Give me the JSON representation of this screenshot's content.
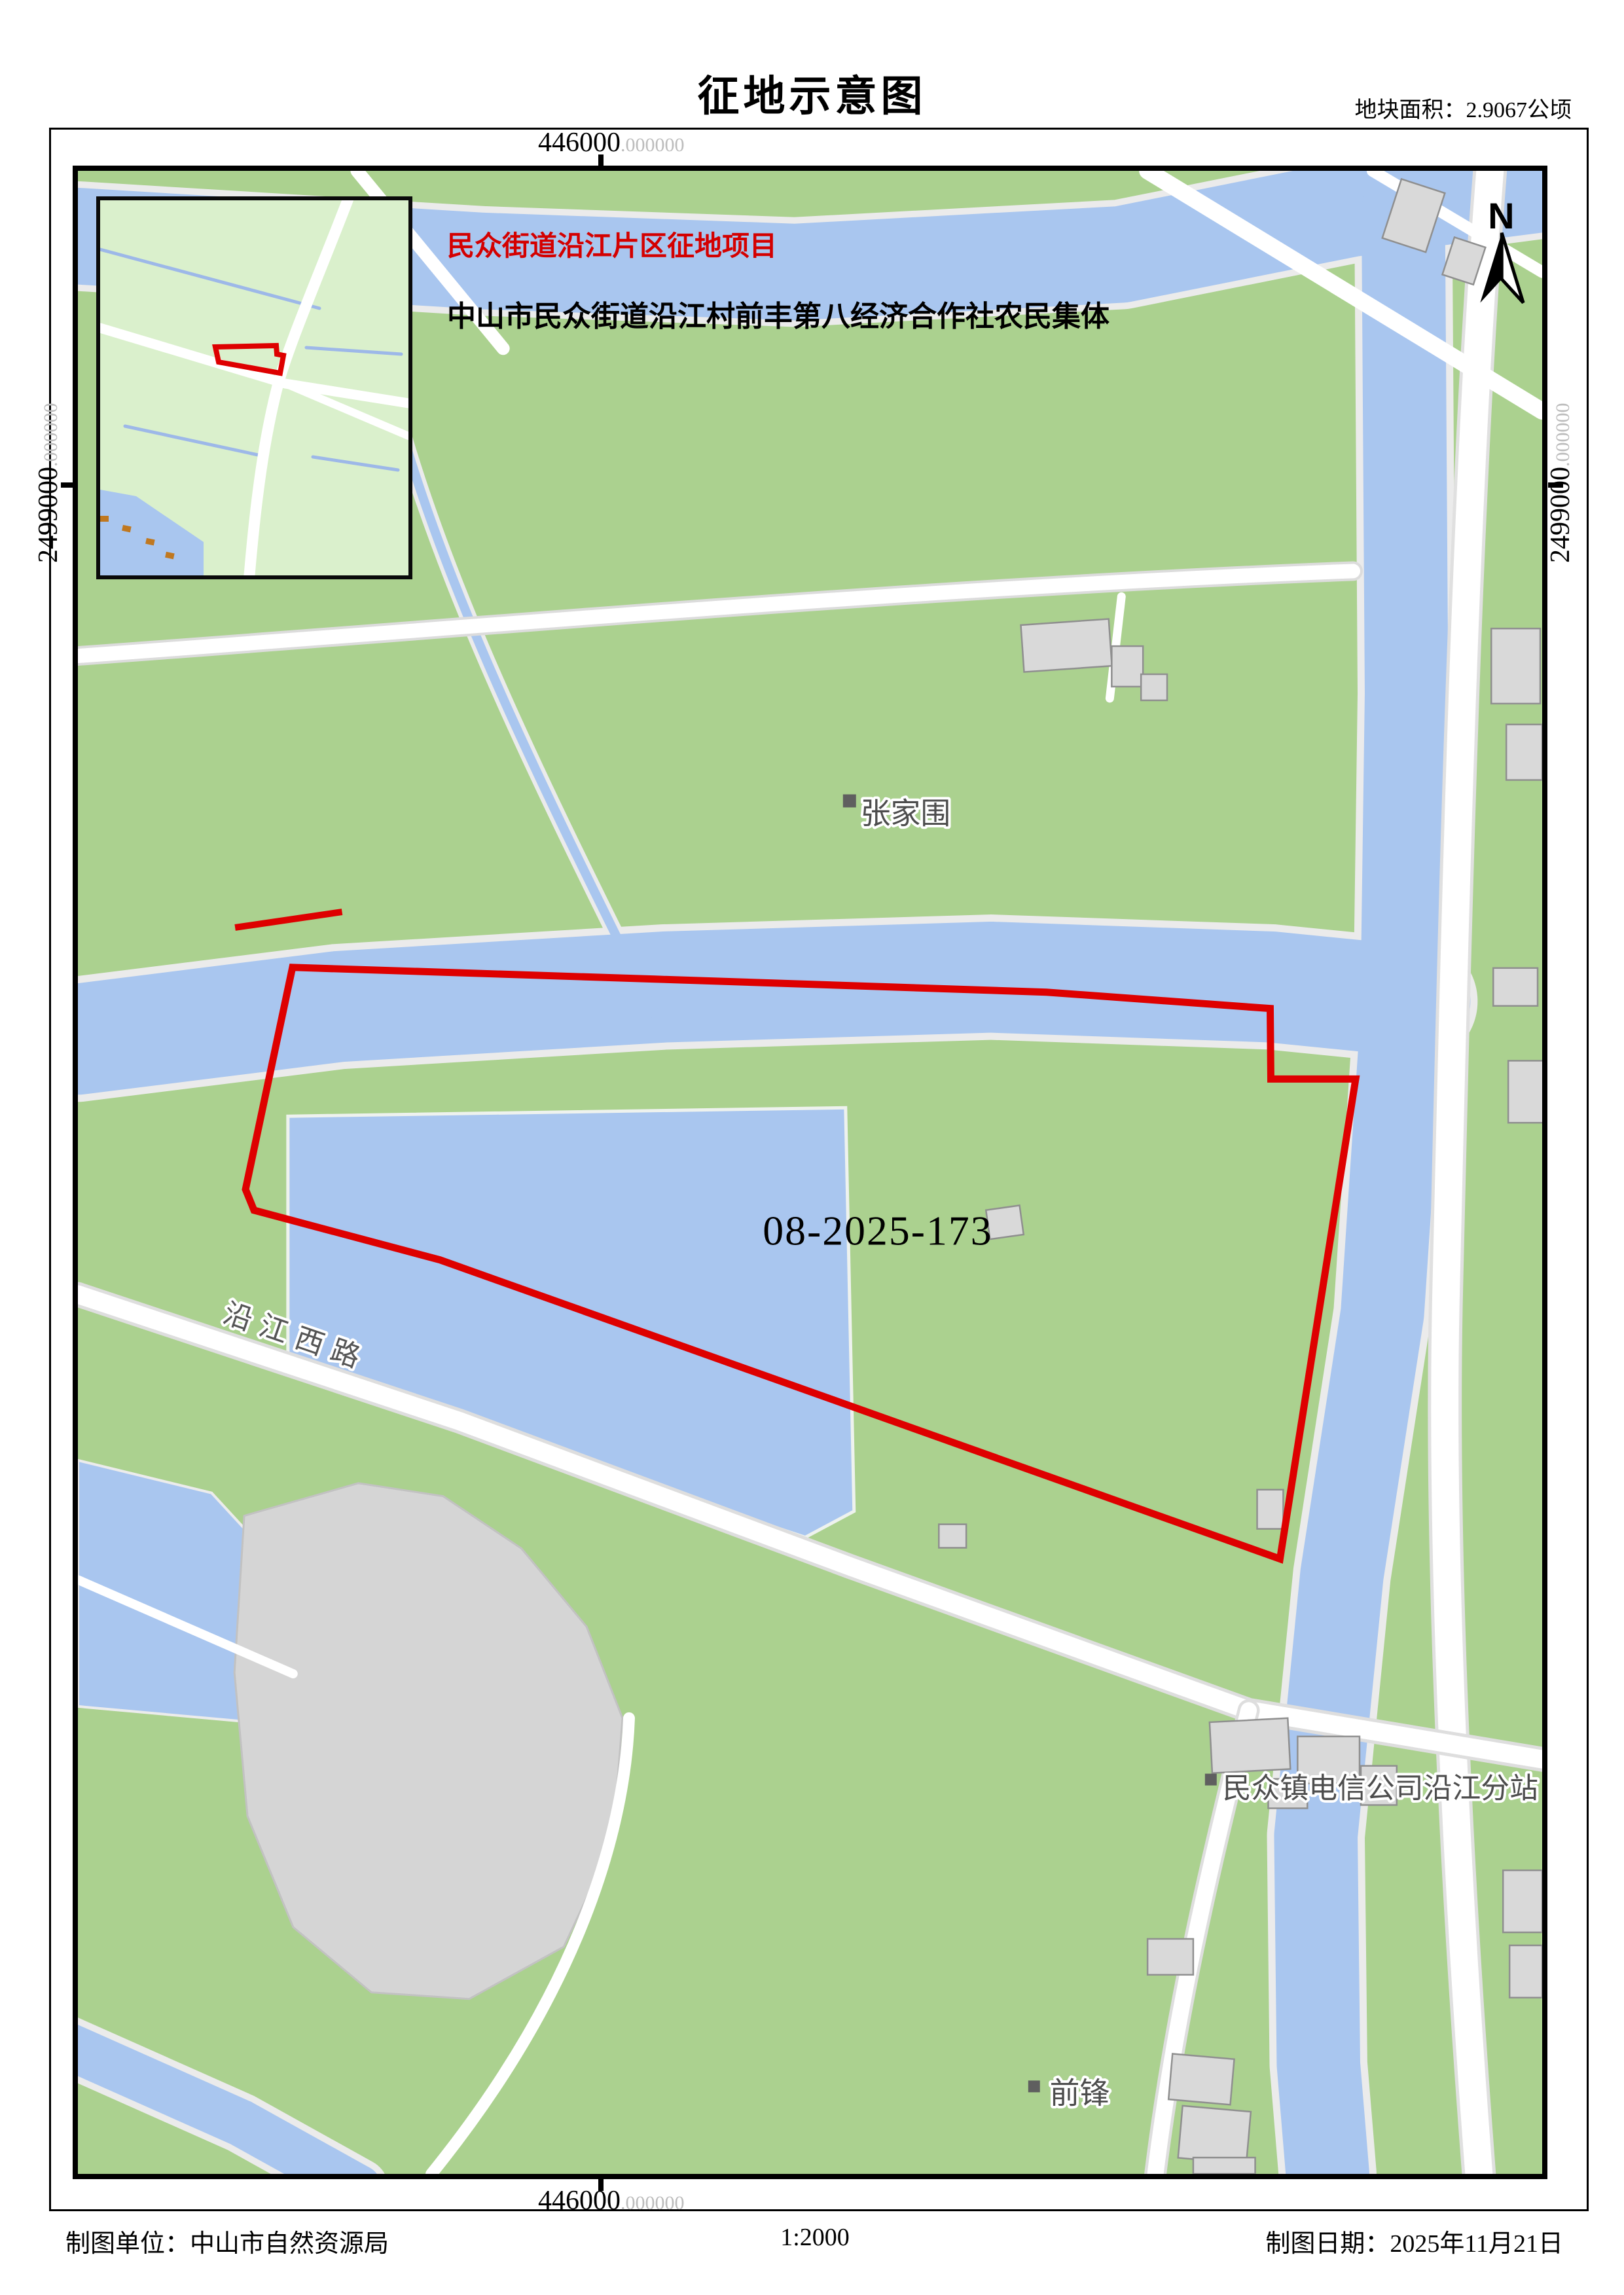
{
  "header": {
    "title": "征地示意图",
    "area_note": "地块面积：2.9067公顷"
  },
  "project": {
    "name": "民众街道沿江片区征地项目",
    "owner": "中山市民众街道沿江村前丰第八经济合作社农民集体"
  },
  "parcel": {
    "id": "08-2025-173",
    "boundary_color": "#de0000"
  },
  "coordinates": {
    "top_easting": "446000",
    "bottom_easting": "446000",
    "left_northing": "2499000",
    "right_northing": "2499000",
    "decimal_suffix": ".000000"
  },
  "compass": {
    "label": "N"
  },
  "map_labels": {
    "village": "张家围",
    "road": "沿江西路",
    "telecom": "民众镇电信公司沿江分站",
    "qianfeng": "前锋"
  },
  "footer": {
    "agency": "制图单位：中山市自然资源局",
    "scale": "1:2000",
    "date": "制图日期：2025年11月21日"
  },
  "colors": {
    "vegetation": "#abd18f",
    "inset_vegetation": "#daf0cc",
    "water": "#a9c6ef",
    "road": "#ffffff",
    "building": "#d9d9d9",
    "gray_area": "#d5d5d5",
    "boundary_red": "#de0000"
  }
}
